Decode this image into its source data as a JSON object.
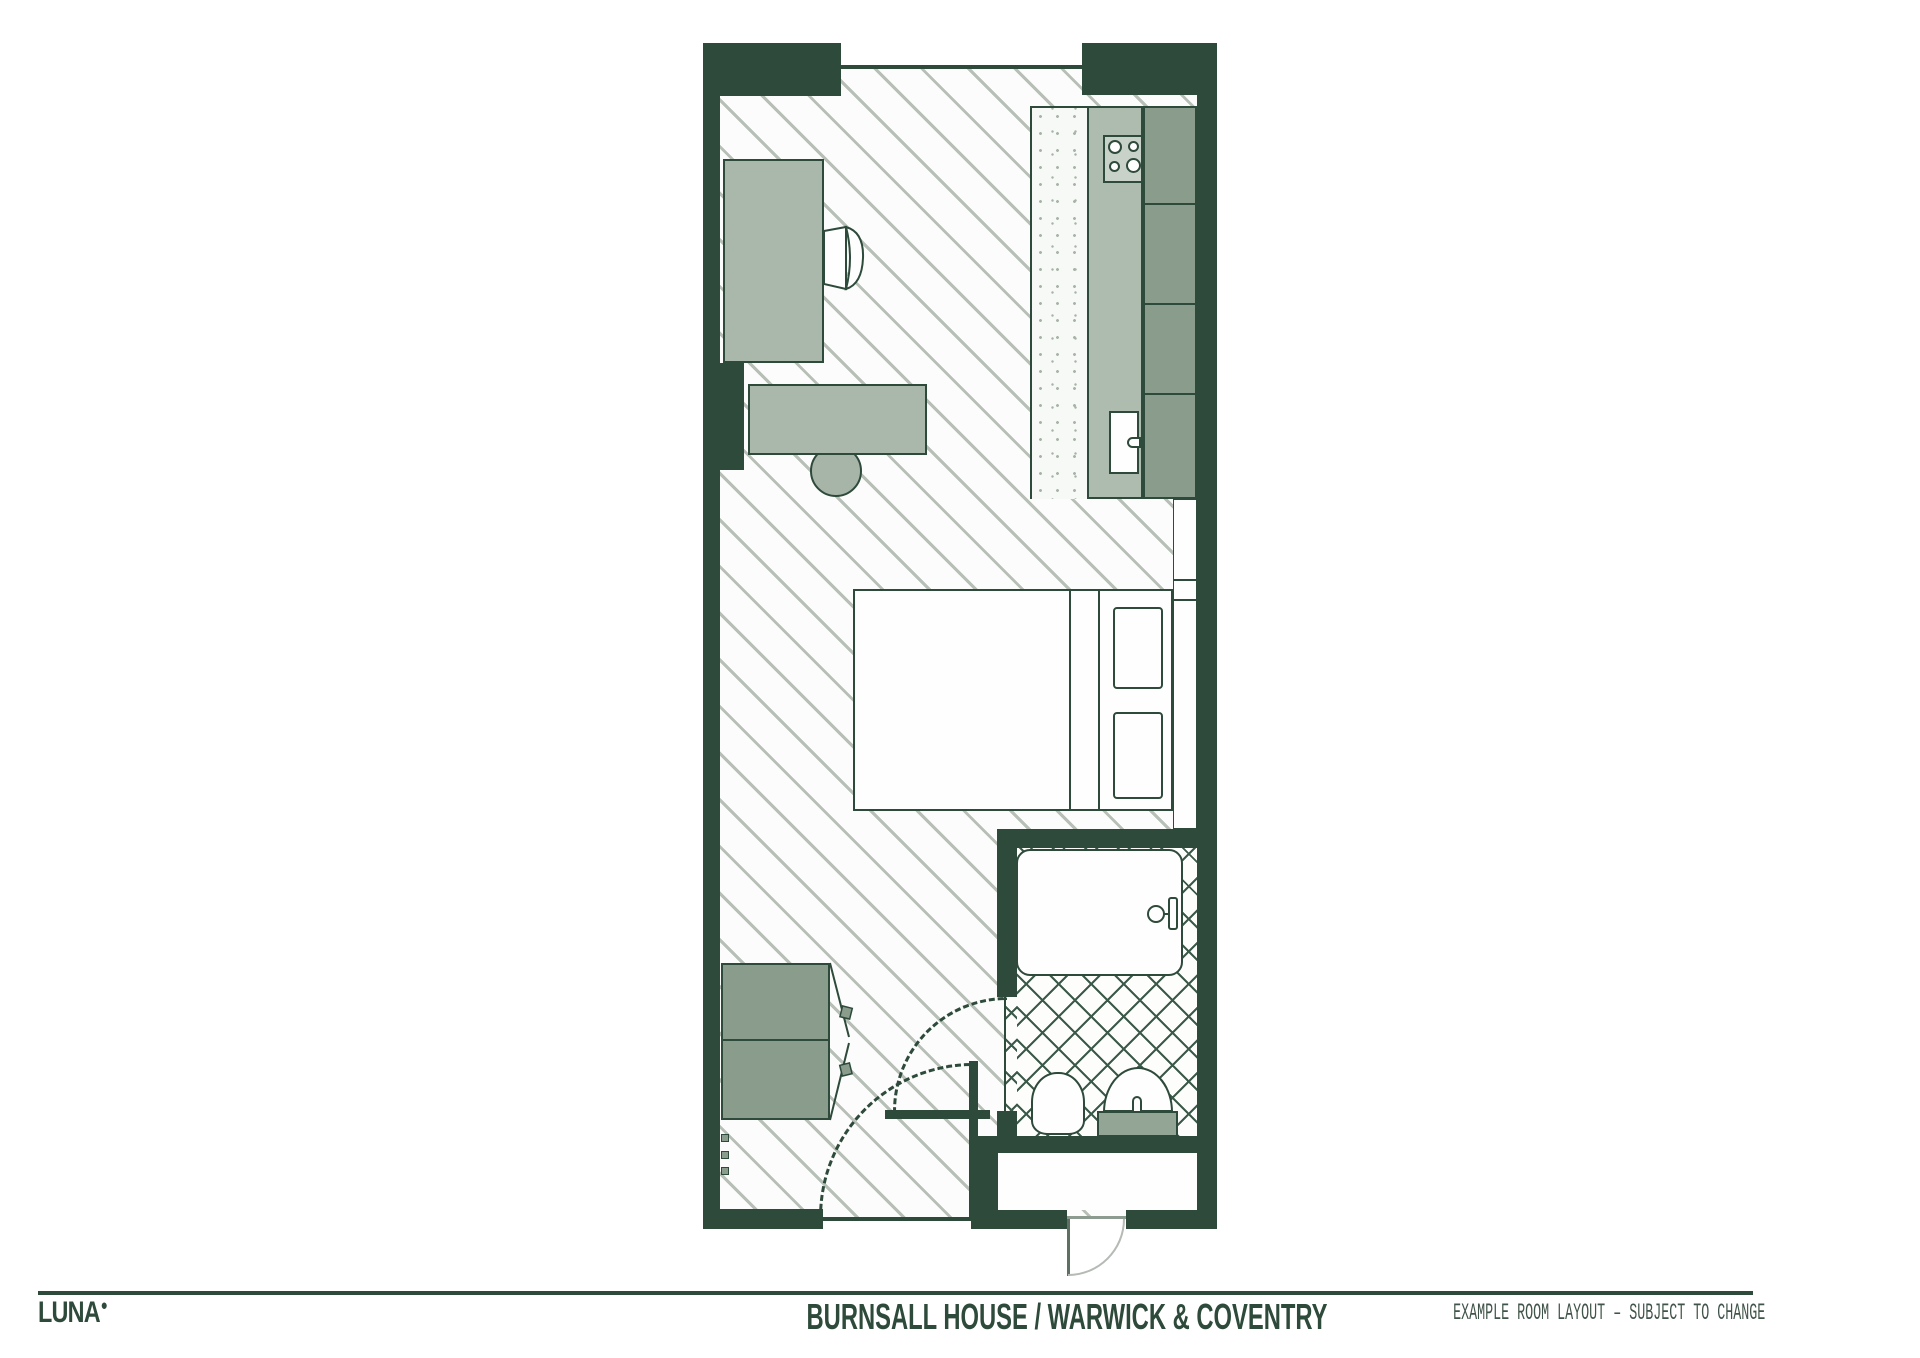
{
  "footer": {
    "logo_text": "LUNA",
    "logo_mark": "●",
    "title": "BURNSALL HOUSE / WARWICK & COVENTRY",
    "note": "EXAMPLE ROOM LAYOUT – SUBJECT TO CHANGE"
  },
  "theme": {
    "wall": "#2e4a3b",
    "outline": "#2e4a3b",
    "sage_mid": "#8a9d8c",
    "sage_desk": "#aab7ab",
    "sage_light": "#aebbaf",
    "sage_stool": "#a7b5a8",
    "sage_pedestal": "#93a595",
    "hob": "#c9d2c8",
    "hatch_line": "#b7bfb7",
    "tile_line": "#3c5a49",
    "stipple_dot": "#a7b4a7",
    "paper": "#ffffff",
    "floor_bg": "#fbfcfb",
    "arc_gray": "#b5bab5",
    "note_color": "#41544a"
  }
}
